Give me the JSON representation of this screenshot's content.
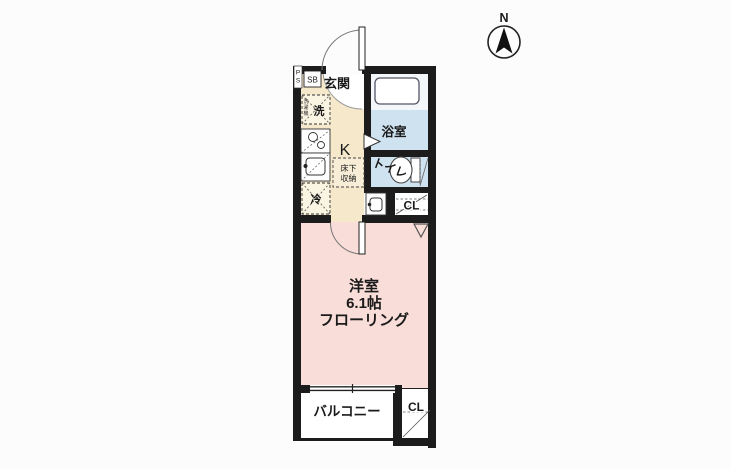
{
  "compass": {
    "north": "N"
  },
  "rooms": {
    "entrance": {
      "label": "玄関"
    },
    "kitchen": {
      "label": "K"
    },
    "bathroom": {
      "label": "浴室"
    },
    "toilet": {
      "label": "トイレ"
    },
    "western_room": {
      "label": "洋室",
      "size": "6.1帖",
      "flooring": "フローリング"
    },
    "balcony": {
      "label": "バルコニー"
    },
    "closet_upper": {
      "label": "CL"
    },
    "closet_lower": {
      "label": "CL"
    }
  },
  "fixtures": {
    "shoe_box": {
      "label": "SB"
    },
    "pipe_space": {
      "chars": [
        "P",
        "S"
      ]
    },
    "washing_machine": {
      "label": "洗",
      "chars": [
        "洗",
        "濯",
        "機"
      ]
    },
    "refrigerator": {
      "label": "冷"
    },
    "underfloor_storage": {
      "line1": "床下",
      "line2": "収納"
    }
  },
  "colors": {
    "wall": "#1c1c1c",
    "kitchen_floor": "#f6e9cb",
    "wet_area_floor": "#cfe2ef",
    "room_floor": "#f9ddd8"
  }
}
